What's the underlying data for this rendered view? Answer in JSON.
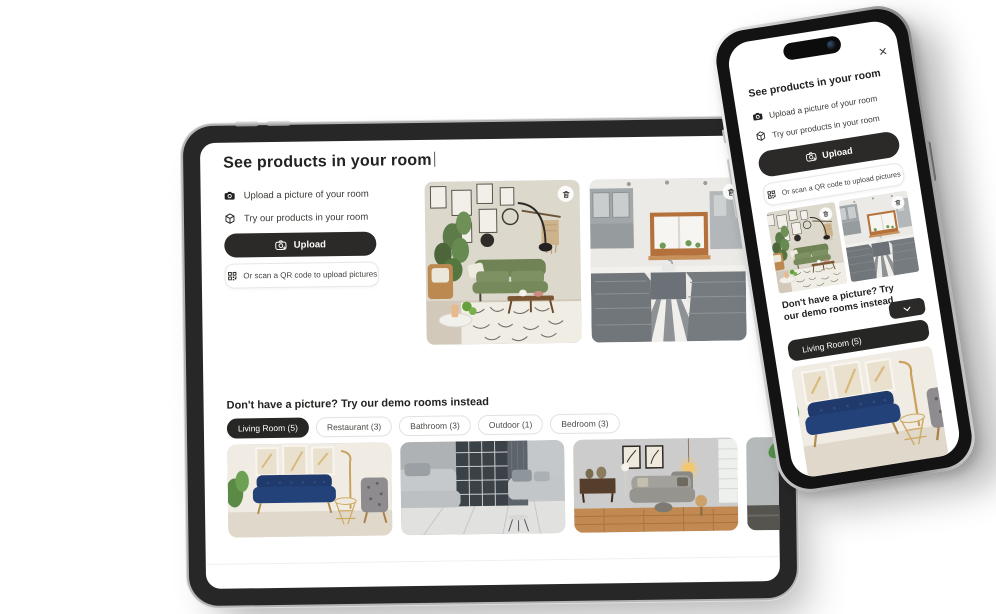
{
  "modal": {
    "title": "See products in your room",
    "bullet_upload": "Upload a picture of your room",
    "bullet_try": "Try our products in your room",
    "upload_button_label": "Upload",
    "qr_label": "Or scan a QR code to upload pictures",
    "demo_heading": "Don't have a picture? Try our demo rooms instead",
    "close_glyph": "✕",
    "tabs": [
      {
        "label": "Living Room (5)",
        "selected": true
      },
      {
        "label": "Restaurant (3)",
        "selected": false
      },
      {
        "label": "Bathroom (3)",
        "selected": false
      },
      {
        "label": "Outdoor (1)",
        "selected": false
      },
      {
        "label": "Bedroom (3)",
        "selected": false
      }
    ]
  },
  "images": {
    "uploaded": [
      "living-room-green-sofa",
      "kitchen-grey-cabinets-striped-floor"
    ],
    "demo": [
      "living-room-navy-sofa",
      "living-room-grey-sofas",
      "living-room-warm-sectional",
      "room-with-plant"
    ]
  },
  "colors": {
    "button_dark": "#2b2a28",
    "selected_tab": "#262624",
    "navy_sofa": "#24427a",
    "background": "#ffffff"
  }
}
